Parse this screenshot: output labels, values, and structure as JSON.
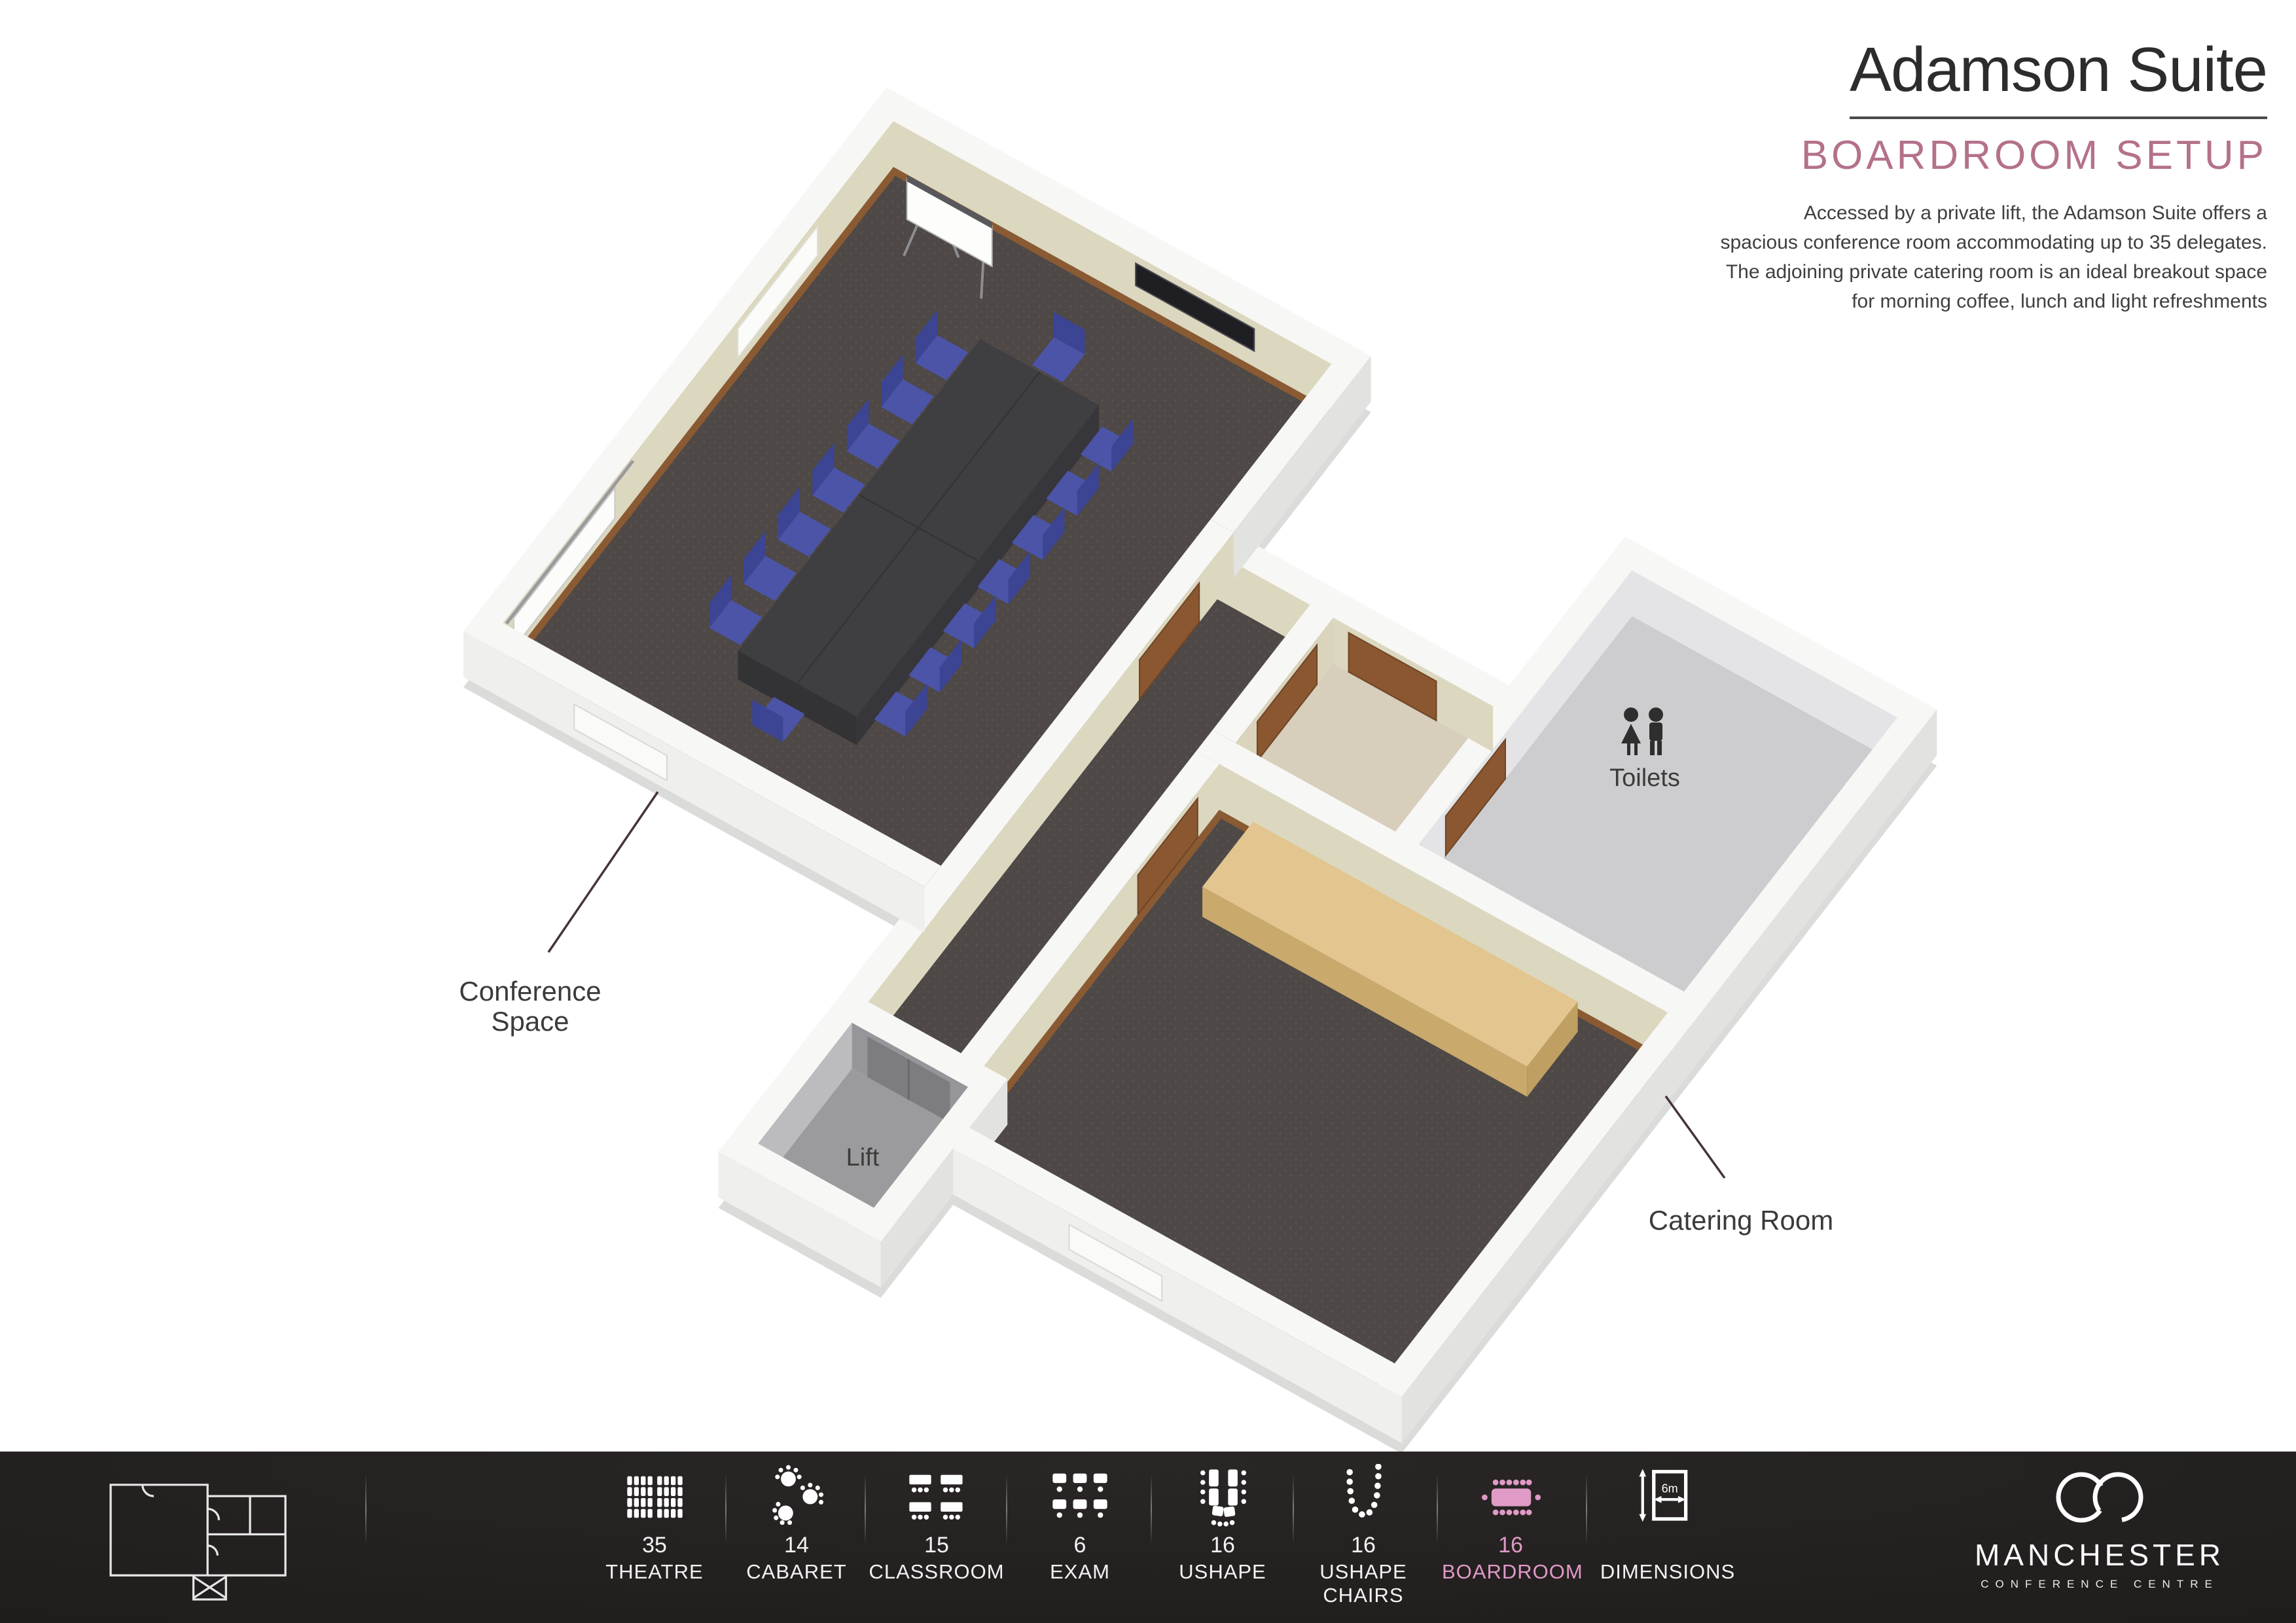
{
  "header": {
    "title": "Adamson Suite",
    "subtitle": "BOARDROOM SETUP",
    "description_lines": [
      "Accessed by a private lift, the Adamson Suite offers a",
      "spacious conference room accommodating up to 35 delegates.",
      "The adjoining private catering room is an ideal breakout space",
      "for morning coffee, lunch and light refreshments"
    ]
  },
  "floorplan": {
    "labels": {
      "conference": "Conference Space",
      "toilets": "Toilets",
      "lift": "Lift",
      "catering": "Catering Room"
    }
  },
  "footer": {
    "capacities": [
      {
        "id": "theatre",
        "label": "THEATRE",
        "value": "35"
      },
      {
        "id": "cabaret",
        "label": "CABARET",
        "value": "14"
      },
      {
        "id": "classroom",
        "label": "CLASSROOM",
        "value": "15"
      },
      {
        "id": "exam",
        "label": "EXAM",
        "value": "6"
      },
      {
        "id": "ushape",
        "label": "USHAPE",
        "value": "16"
      },
      {
        "id": "ushape-chairs",
        "label": "USHAPE CHAIRS",
        "value": "16"
      },
      {
        "id": "boardroom",
        "label": "BOARDROOM",
        "value": "16",
        "highlighted": true
      },
      {
        "id": "dimensions",
        "label": "DIMENSIONS",
        "value": "",
        "dimension_width_label": "6m"
      }
    ],
    "logo": {
      "name": "MANCHESTER",
      "tagline": "CONFERENCE  CENTRE"
    }
  },
  "colors": {
    "accent_rose": "#b4718b",
    "accent_pink": "#df9ac6",
    "footer_bg": "#201d1d",
    "wall_cream": "#dcd7bf",
    "carpet": "#4e4847",
    "chair_blue": "#4c54a8",
    "door_brown": "#8a5731",
    "wood_table": "#e2c58f"
  }
}
